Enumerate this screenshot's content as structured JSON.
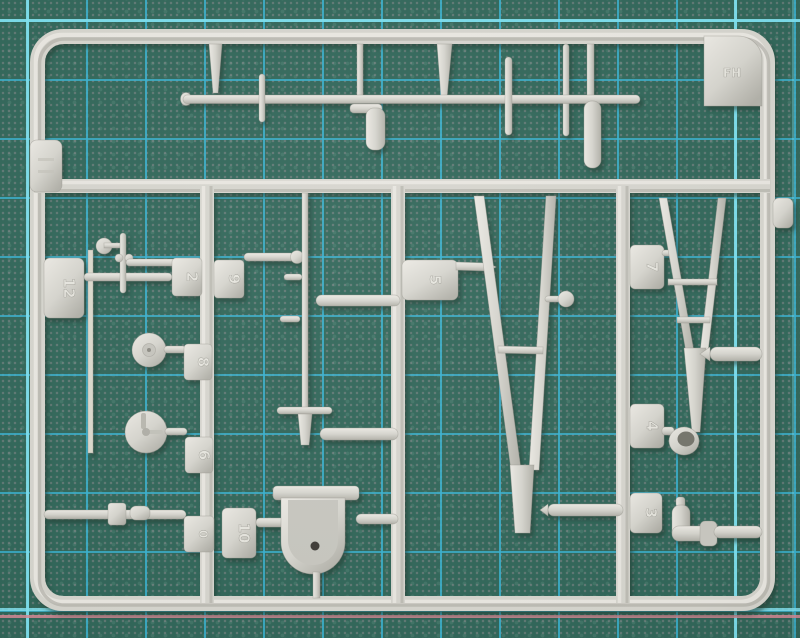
{
  "scene": {
    "description": "Photograph of a light grey injection-moulded model kit sprue (runner with parts) lying on a green self-healing cutting mat with cyan grid lines",
    "corner_label": "FH"
  },
  "theme": {
    "matBase": "#32675a",
    "gridThin": "#3ab2d0",
    "gridMajor": "#82e2ef",
    "gridPink": "#d88b97",
    "plasticLight": "#eceae4",
    "plasticMid": "#d6d5ce",
    "plasticDark": "#b2b1a9"
  },
  "sprue": {
    "corner_label": "FH",
    "tabs": [
      {
        "label": "12"
      },
      {
        "label": "2"
      },
      {
        "label": "9"
      },
      {
        "label": "8"
      },
      {
        "label": "6"
      },
      {
        "label": "0"
      },
      {
        "label": "10"
      },
      {
        "label": "5"
      },
      {
        "label": "7"
      },
      {
        "label": "4"
      },
      {
        "label": "3"
      }
    ],
    "parts": [
      "long thin mast rod with fins",
      "tapered rods and exhaust elbow",
      "small anemometer-style mast with ball arm",
      "two small wheels / reels",
      "tall antenna mast with crossbar",
      "two cylindrical rods",
      "open seat tub with hole",
      "large V-shaped strut with crossbar and knob",
      "small V-shaped ladder strut",
      "small cup fitting",
      "elbow pipe with collar",
      "beaded rod"
    ]
  }
}
